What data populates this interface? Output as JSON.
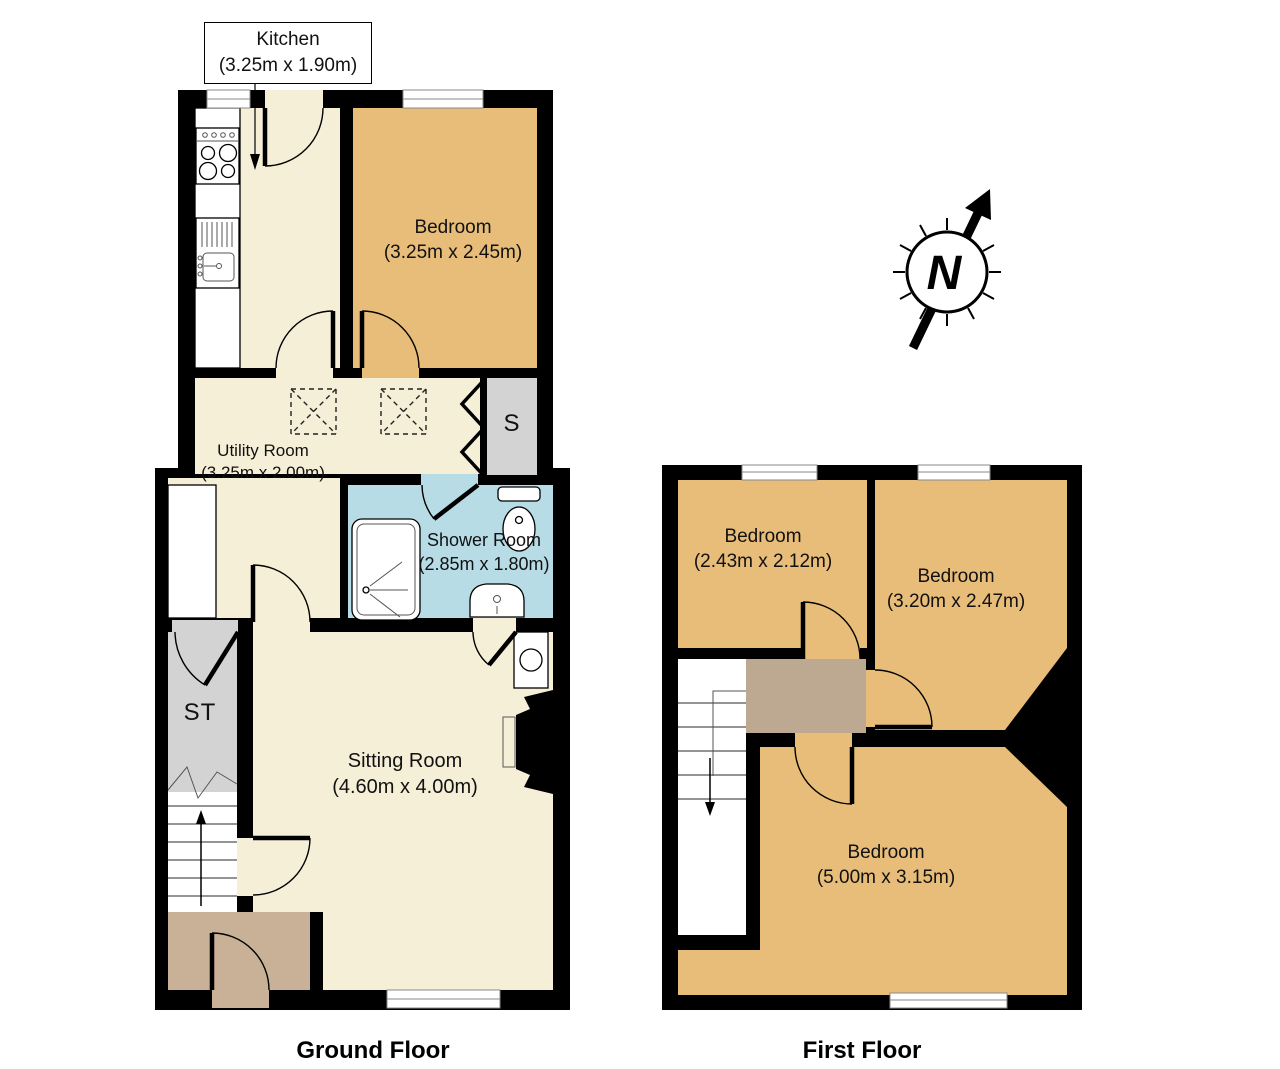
{
  "callout": {
    "room": "Kitchen",
    "dims": "(3.25m x 1.90m)"
  },
  "compass": {
    "letter": "N"
  },
  "floors": {
    "ground": {
      "title": "Ground Floor",
      "bedroom": {
        "name": "Bedroom",
        "dims": "(3.25m x 2.45m)"
      },
      "utility": {
        "name": "Utility Room",
        "dims": "(3.25m x 2.00m)"
      },
      "shower": {
        "name": "Shower Room",
        "dims": "(2.85m x 1.80m)"
      },
      "sitting": {
        "name": "Sitting Room",
        "dims": "(4.60m x 4.00m)"
      },
      "storage_st": "ST",
      "storage_s": "S"
    },
    "first": {
      "title": "First Floor",
      "bedroom1": {
        "name": "Bedroom",
        "dims": "(2.43m x 2.12m)"
      },
      "bedroom2": {
        "name": "Bedroom",
        "dims": "(3.20m x 2.47m)"
      },
      "bedroom3": {
        "name": "Bedroom",
        "dims": "(5.00m x 3.15m)"
      }
    }
  },
  "colors": {
    "wall_black": "#000000",
    "floor_cream": "#f6efd7",
    "bedroom_tan": "#e7bd79",
    "hall_brown": "#c8b196",
    "landing_brown": "#bda892",
    "shower_blue": "#b7dce6",
    "cupboard_grey": "#d3d3d3"
  }
}
